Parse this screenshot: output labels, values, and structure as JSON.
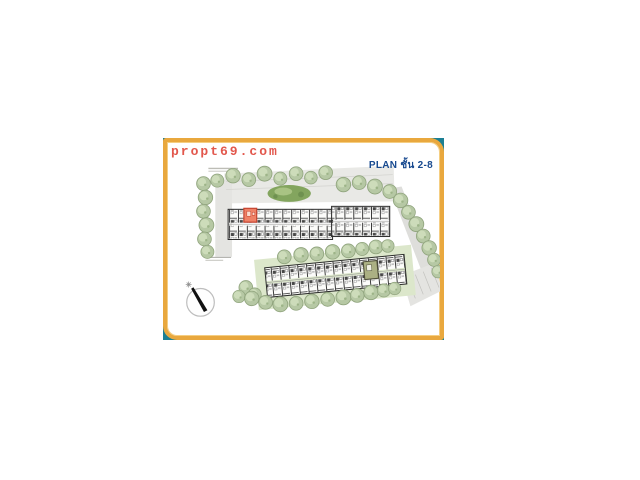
{
  "watermark": {
    "text": "propt69.com",
    "color": "#E2574C"
  },
  "plan": {
    "title": "PLAN ชั้น 2-8",
    "title_color": "#17498F",
    "highlight_color": "#EF8166",
    "highlight_stroke": "#C4432F",
    "core_highlight_color": "#ABB083",
    "backdrop_color": "#1B7F93",
    "frame_color": "#E9A83E",
    "tree_color": "#B6C8A4",
    "garden_color": "#83A55E",
    "road_color": "#E7E7E4",
    "building_outline": "#2B2B2B",
    "compass_direction": "NW"
  }
}
